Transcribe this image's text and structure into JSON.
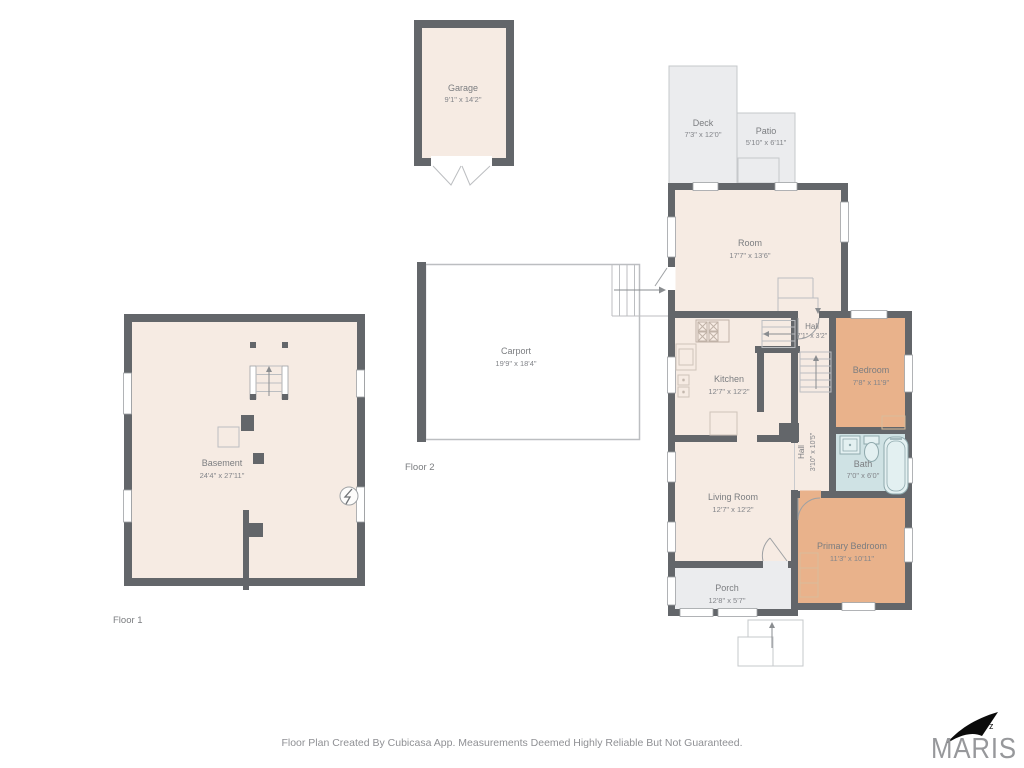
{
  "rooms": {
    "garage": {
      "name": "Garage",
      "dims": "9'1\" x 14'2\""
    },
    "deck": {
      "name": "Deck",
      "dims": "7'3\" x 12'0\""
    },
    "patio": {
      "name": "Patio",
      "dims": "5'10\" x 6'11\""
    },
    "room": {
      "name": "Room",
      "dims": "17'7\" x 13'6\""
    },
    "hall_upper": {
      "name": "Hall",
      "dims": "7'1\" x 3'2\""
    },
    "bedroom": {
      "name": "Bedroom",
      "dims": "7'8\" x 11'9\""
    },
    "kitchen": {
      "name": "Kitchen",
      "dims": "12'7\" x 12'2\""
    },
    "carport": {
      "name": "Carport",
      "dims": "19'9\" x 18'4\""
    },
    "basement": {
      "name": "Basement",
      "dims": "24'4\" x 27'11\""
    },
    "hall_lower": {
      "name": "Hall",
      "dims": "3'10\" x 10'5\""
    },
    "bath": {
      "name": "Bath",
      "dims": "7'0\" x 6'0\""
    },
    "living_room": {
      "name": "Living Room",
      "dims": "12'7\" x 12'2\""
    },
    "primary_bedroom": {
      "name": "Primary Bedroom",
      "dims": "11'3\" x 10'11\""
    },
    "porch": {
      "name": "Porch",
      "dims": "12'8\" x 5'7\""
    }
  },
  "floor_labels": {
    "floor1": "Floor 1",
    "floor2": "Floor 2"
  },
  "footer": {
    "disclaimer": "Floor Plan Created By Cubicasa App. Measurements Deemed Highly Reliable But Not Guaranteed."
  },
  "branding": {
    "logo_text": "MARIS"
  },
  "colors": {
    "wall": "#63666a",
    "room_fill": "#f6ebe3",
    "bedroom_fill": "#e9b28b",
    "bath_fill": "#cfe2e4",
    "outdoor_fill": "#ebecee",
    "carport_fill": "#ffffff",
    "thin_line": "#bcbec1",
    "label_text": "#7b7d80"
  }
}
